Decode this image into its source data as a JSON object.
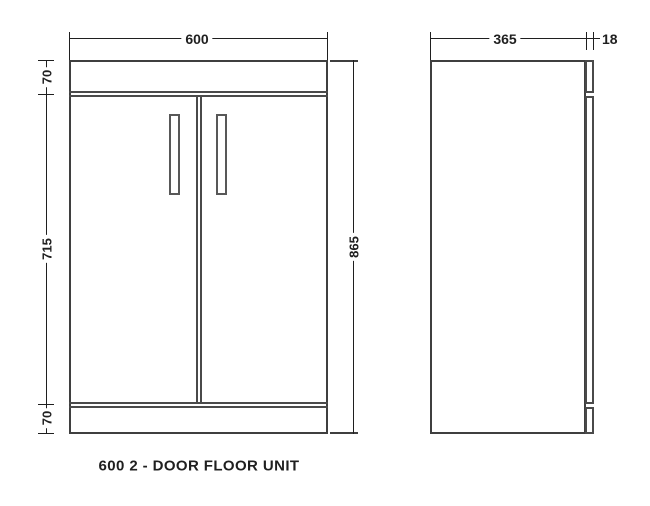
{
  "drawing": {
    "caption": "600 2 - DOOR FLOOR UNIT",
    "front_view": {
      "width_mm": "600",
      "total_height_mm": "865",
      "top_panel_mm": "70",
      "door_height_mm": "715",
      "plinth_mm": "70"
    },
    "side_view": {
      "depth_mm": "365",
      "door_thickness_mm": "18"
    },
    "colors": {
      "outline": "#3f3f3f",
      "inner_line": "#4a4a4a",
      "handle": "#585858",
      "dimension": "#1f1f1f",
      "background": "#ffffff"
    }
  }
}
